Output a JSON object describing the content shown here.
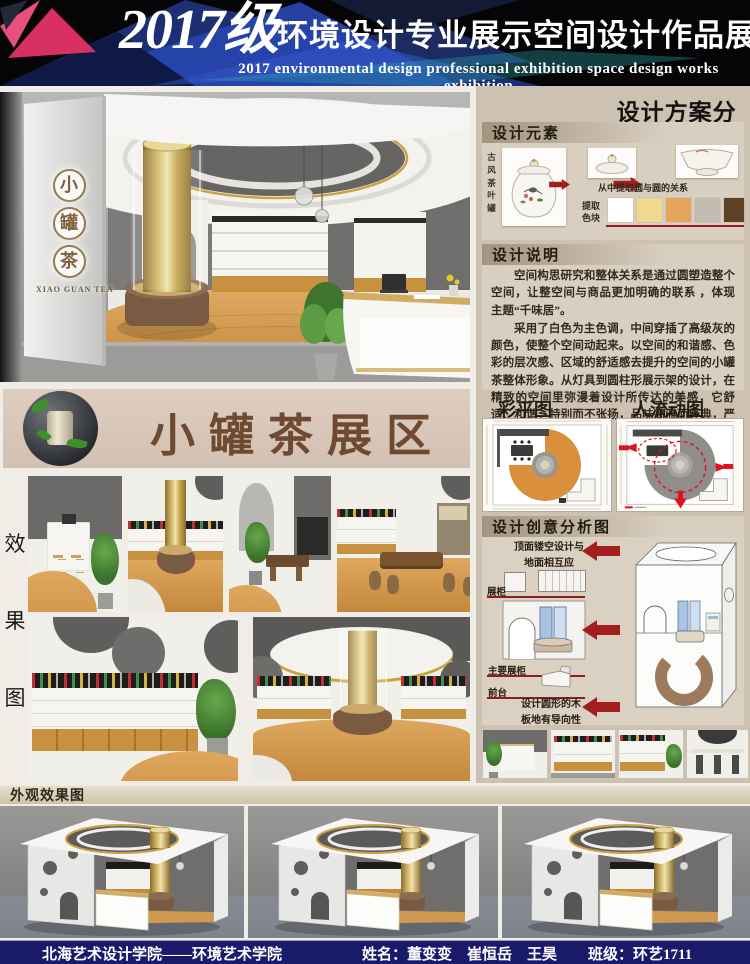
{
  "header": {
    "year": "2017级",
    "title_cn": "环境设计专业展示空间设计作品展",
    "subtitle_en": "2017 environmental design professional exhibition space design works exhibition"
  },
  "brand": {
    "logo_chars": [
      "小",
      "罐",
      "茶"
    ],
    "logo_en": "XIAO GUAN TEA"
  },
  "banner": {
    "title": "小罐茶展区"
  },
  "effects_label": {
    "chars": [
      "效",
      "果",
      "图"
    ]
  },
  "analysis": {
    "title": "设计方案分析",
    "elements": {
      "title": "设计元素",
      "jar_label": "古风茶叶罐",
      "relation_caption": "从中提取圆与圆的关系",
      "palette_label": "提取色块",
      "palette": [
        "#ffffff",
        "#eed98f",
        "#e2a55b",
        "#c3bcb2",
        "#5b4226"
      ]
    },
    "description": {
      "title": "设计说明",
      "para1": "空间构思研究和整体关系是通过圆塑造整个空间，让整空间与商品更加明确的联系 ，体现主题“千味居”。",
      "para2": "采用了白色为主色调，中间穿插了高级灰的颜色，使整个空间动起来。以空间的和谐感、色彩的层次感、区域的舒适感去提升的空间的小罐茶整体形象。从灯具到圆柱形展示架的设计，在精致的空间里弥漫着设计所传达的美感，它舒适、和谐，特别而不张扬，品味高雅而经典，严谨中透出细部的优雅。"
    },
    "plans": {
      "color_plan_title": "彩平图",
      "flow_plan_title": "人流动图"
    },
    "creative": {
      "title": "设计创意分析图",
      "note_top": "顶面镂空设计与地面相互应",
      "label_display": "展柜",
      "label_main_display": "主要展柜",
      "label_front_desk": "前台",
      "note_bottom": "设计圆形的木板地有导向性"
    }
  },
  "exterior": {
    "title": "外观效果图"
  },
  "footer": {
    "school": "北海艺术设计学院——环境艺术学院",
    "names": "姓名：董变变    崔恒岳    王昊",
    "class": "班级：环艺1711"
  }
}
